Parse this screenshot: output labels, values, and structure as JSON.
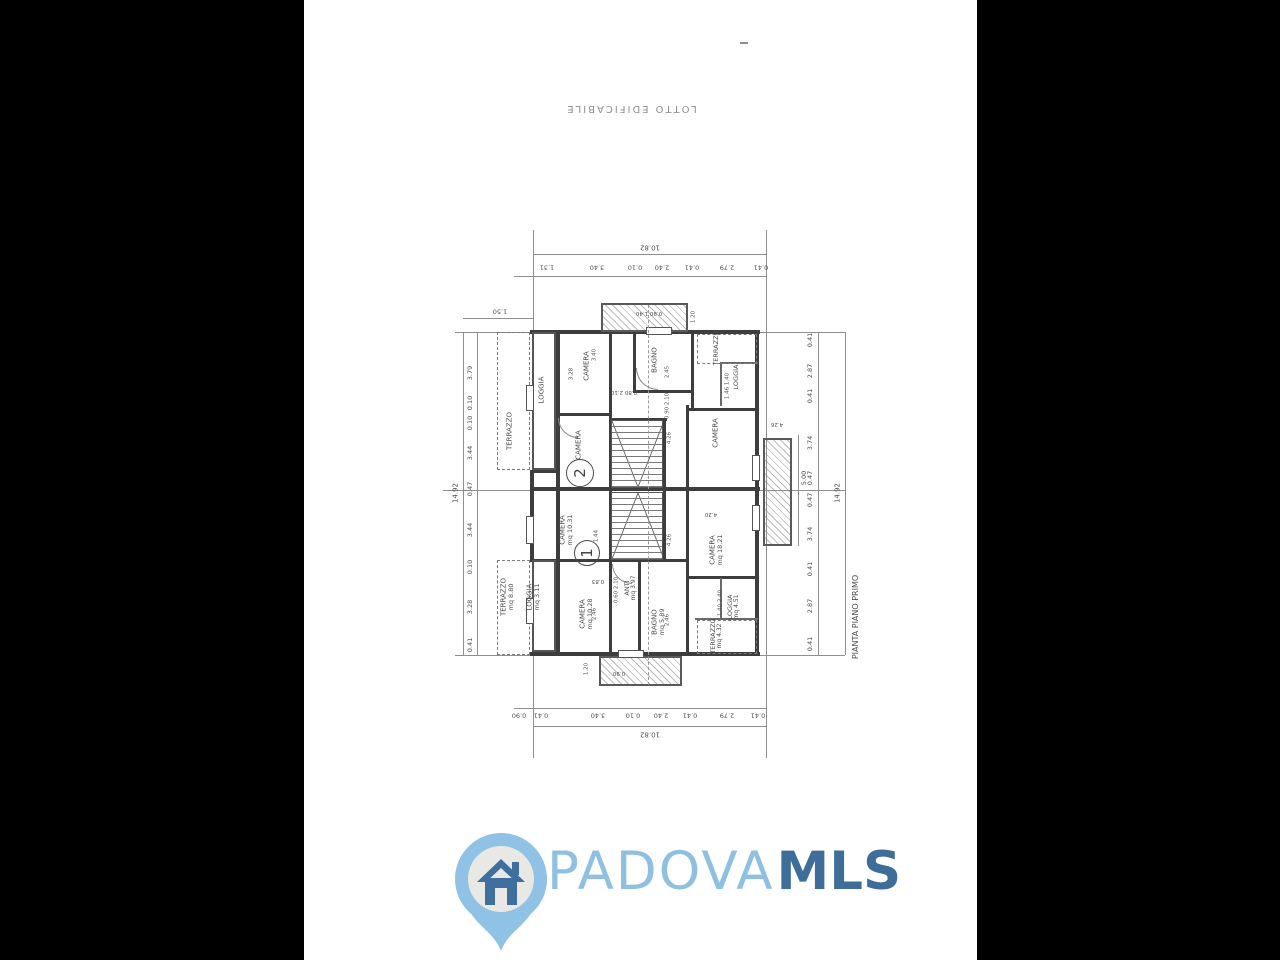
{
  "page": {
    "top_label": "LOTTO EDIFICABILE"
  },
  "plan": {
    "title": "PIANTA PIANO PRIMO",
    "unit_badges": [
      "1",
      "2"
    ],
    "rooms": {
      "terrazzo_u2l": {
        "label": "TERRAZZO"
      },
      "loggia_u2l": {
        "label": "LOGGIA"
      },
      "camera_u2_tl": {
        "label": "CAMERA"
      },
      "bagno_u2": {
        "label": "BAGNO"
      },
      "camera_u2_c": {
        "label": "CAMERA"
      },
      "camera_u2_r": {
        "label": "CAMERA"
      },
      "terrazzo_u2r": {
        "label": "TERRAZZO"
      },
      "loggia_u2r": {
        "label": "LOGGIA"
      },
      "camera_1031": {
        "label": "CAMERA",
        "area": "mq 10.31"
      },
      "camera_1028": {
        "label": "CAMERA",
        "area": "mq 10.28"
      },
      "anti": {
        "label": "ANTI",
        "area": "mq 3.97"
      },
      "bagno_u1": {
        "label": "BAGNO",
        "area": "mq 5.89"
      },
      "camera_1821": {
        "label": "CAMERA",
        "area": "mq 18.21"
      },
      "loggia_451": {
        "label": "LOGGIA",
        "area": "mq 4.51"
      },
      "terrazzo_432": {
        "label": "TERRAZZO",
        "area": "mq 4.32"
      },
      "terrazzo_880": {
        "label": "TERRAZZO",
        "area": "mq 8.80"
      },
      "loggia_311": {
        "label": "LOGGIA",
        "area": "mq 3.11"
      }
    },
    "dims": {
      "top": {
        "total": "10.82",
        "segments": [
          "1.31",
          "3.40",
          "0.10",
          "2.40",
          "0.41",
          "2.79",
          "0.41"
        ]
      },
      "bottom": {
        "total": "10.82",
        "segments": [
          "0.90",
          "0.41",
          "3.40",
          "0.10",
          "2.40",
          "0.41",
          "2.79",
          "0.41"
        ]
      },
      "left": {
        "total": "14.92",
        "offset": "1.50",
        "segments": [
          "3.79",
          "0.10",
          "0.10",
          "3.44",
          "0.47",
          "3.44",
          "0.10",
          "3.28",
          "0.41"
        ]
      },
      "right": {
        "total": "14.92",
        "inner": "5.00",
        "segments": [
          "0.41",
          "2.87",
          "0.41",
          "3.74",
          "0.47",
          "0.47",
          "3.74",
          "0.41",
          "2.87",
          "0.41"
        ]
      }
    },
    "small_dims": [
      "0.90 1.40",
      "1.20",
      "2.45",
      "3.40",
      "3.28",
      "1.44",
      "0.83",
      "0.60 2.10",
      "2.46",
      "2.46",
      "0.80 2.10",
      "0.90 2.10",
      "1.46 1.40",
      "1.40 2.40",
      "1.20",
      "0.90",
      "4.26",
      "4.26",
      "4.20",
      "4.26"
    ]
  },
  "logo": {
    "name": "PADOVA",
    "suffix": "MLS",
    "colors": {
      "light_blue": "#8fc0e2",
      "dark_blue": "#3e6d99",
      "inner_gray": "#e9e8e5"
    }
  }
}
